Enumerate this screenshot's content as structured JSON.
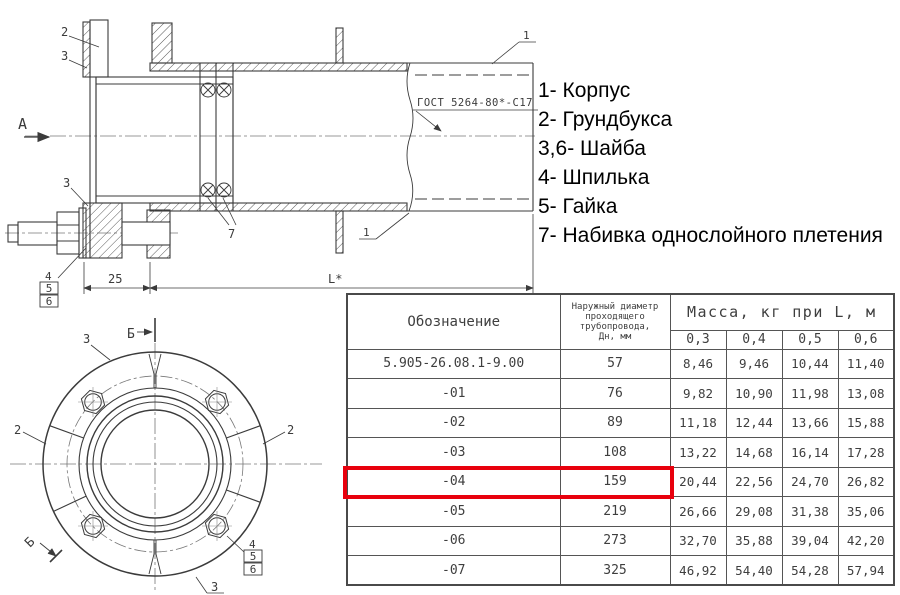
{
  "legend": {
    "items": [
      "1- Корпус",
      "2- Грундбукса",
      "3,6- Шайба",
      "4- Шпилька",
      "5- Гайка",
      "7- Набивка однослойного плетения"
    ]
  },
  "table": {
    "designation_header": "Обозначение",
    "diameter_header_lines": [
      "Наружный диаметр",
      "проходящего",
      "трубопровода,",
      "Дн, мм"
    ],
    "mass_header": "Масса, кг при L, м",
    "length_columns": [
      "0,3",
      "0,4",
      "0,5",
      "0,6"
    ],
    "rows": [
      {
        "designation": "5.905-26.08.1-9.00",
        "dn": "57",
        "m": [
          "8,46",
          "9,46",
          "10,44",
          "11,40"
        ]
      },
      {
        "designation": "-01",
        "dn": "76",
        "m": [
          "9,82",
          "10,90",
          "11,98",
          "13,08"
        ]
      },
      {
        "designation": "-02",
        "dn": "89",
        "m": [
          "11,18",
          "12,44",
          "13,66",
          "15,88"
        ]
      },
      {
        "designation": "-03",
        "dn": "108",
        "m": [
          "13,22",
          "14,68",
          "16,14",
          "17,28"
        ]
      },
      {
        "designation": "-04",
        "dn": "159",
        "m": [
          "20,44",
          "22,56",
          "24,70",
          "26,82"
        ],
        "highlighted": true
      },
      {
        "designation": "-05",
        "dn": "219",
        "m": [
          "26,66",
          "29,08",
          "31,38",
          "35,06"
        ]
      },
      {
        "designation": "-06",
        "dn": "273",
        "m": [
          "32,70",
          "35,88",
          "39,04",
          "42,20"
        ]
      },
      {
        "designation": "-07",
        "dn": "325",
        "m": [
          "46,92",
          "54,40",
          "54,28",
          "57,94"
        ]
      }
    ],
    "highlight_color": "#e8000d"
  },
  "drawing": {
    "section_view": {
      "view_label": "А",
      "weld_note": "ГОСТ 5264-80*-С17",
      "dim_gland": "25",
      "dim_length": "L*",
      "callout_body": "1",
      "callout_gland": "2",
      "callout_washer": "3",
      "callout_stud": "4",
      "callout_nut": "5",
      "callout_washer2": "6",
      "callout_packing": "7"
    },
    "flange_view": {
      "section_label": "Б",
      "callout_gland": "2",
      "callout_washer": "3",
      "callout_stud": "4",
      "callout_nut": "5",
      "callout_washer2": "6"
    }
  }
}
